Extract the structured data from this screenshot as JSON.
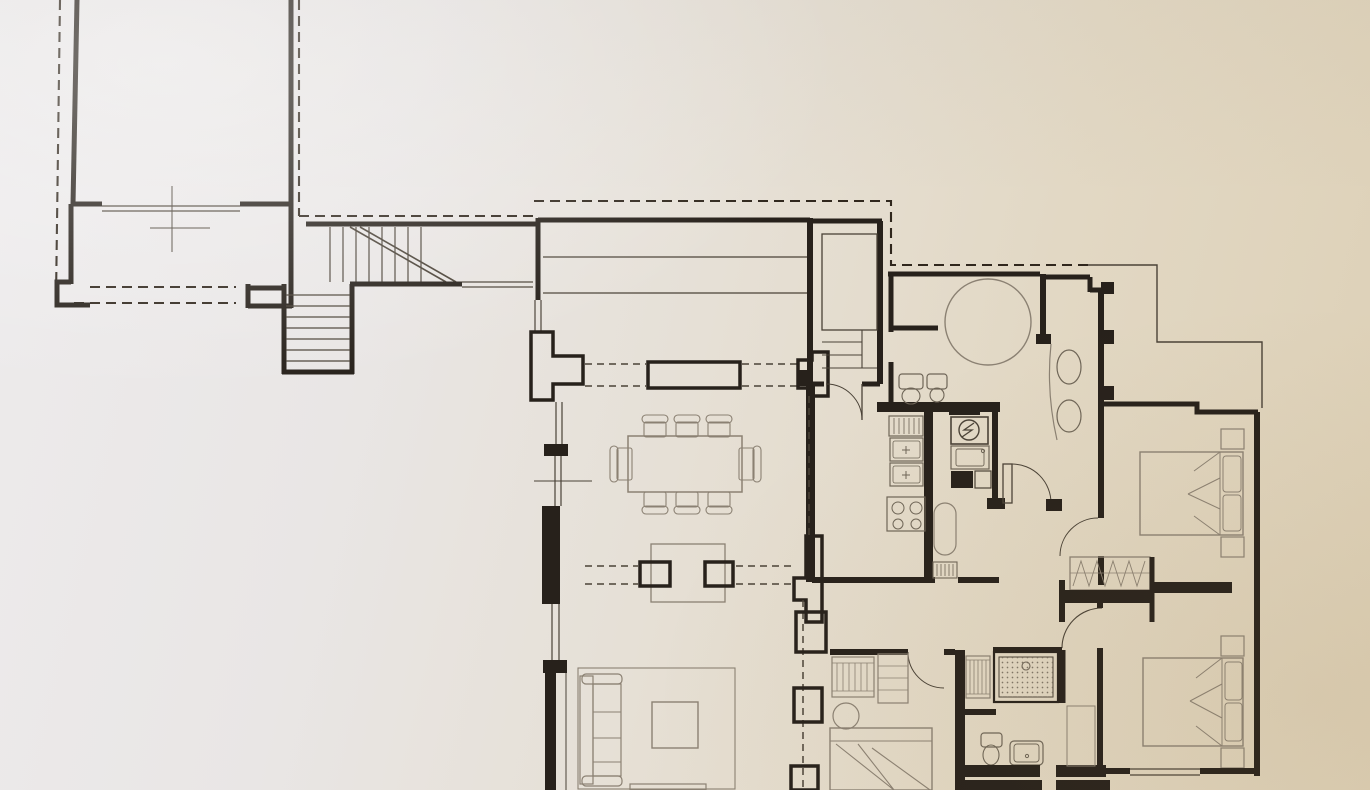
{
  "scene": {
    "description": "Scanned architectural floor plan photographed on warm-toned paper; line drawing only, no text labels visible",
    "view": "top-down plan view",
    "style": "ink on paper, thick walls, dashed boundary and section lines"
  },
  "palette": {
    "paper_light": "#edebec",
    "paper_warm": "#e2d8c4",
    "paper_deep": "#ddd0b6",
    "wall": "#27211b",
    "line_med": "#4a4237",
    "line_light": "#8b8173",
    "line_fix": "#6e6557",
    "dash": "#30271d"
  },
  "inventory": {
    "rooms": [
      "annex-room-top-left",
      "lower-corridor",
      "main-staircase-hall",
      "terrace-deck-strip",
      "dining-room",
      "living-room",
      "entry-stair-room",
      "kitchen",
      "bathroom-with-round-tub",
      "vanity-room",
      "hallway",
      "bedroom-top-right",
      "bedroom-bottom-right",
      "bedroom-bottom-left",
      "shower-bathroom"
    ],
    "stairs": {
      "main_staircase_shape": "L",
      "main_upper_treads": 8,
      "main_lower_treads": 7,
      "has_diagonal_cut_line": true,
      "entry_room_steps": 3
    },
    "furniture_counts": {
      "dining_table_chairs": 8,
      "sofa": 1,
      "coffee_table": 1,
      "rug": 1,
      "double_beds": 3,
      "nightstands": 4,
      "round_side_table": 1,
      "wardrobes_with_hanger_symbols": 3,
      "shelved_closet": 1,
      "zigzag_hanger_wardrobe": 1
    },
    "fixture_counts": {
      "round_tub": 1,
      "toilets": 2,
      "bidet": 1,
      "vanity_basins": 2,
      "shower_tray_with_drain": 1,
      "washbasin": 1,
      "kitchen_sink_bowls": 2,
      "gas_hob_burners": 4,
      "utility_sink": 1,
      "circled_appliance_symbol": 1
    },
    "annotations": {
      "dashed_boundary_lines": true,
      "dashed_beam_section_lines": true,
      "survey_centerline_crosses": 2,
      "door_swing_arcs": 6,
      "structural_pillars": 5
    }
  }
}
